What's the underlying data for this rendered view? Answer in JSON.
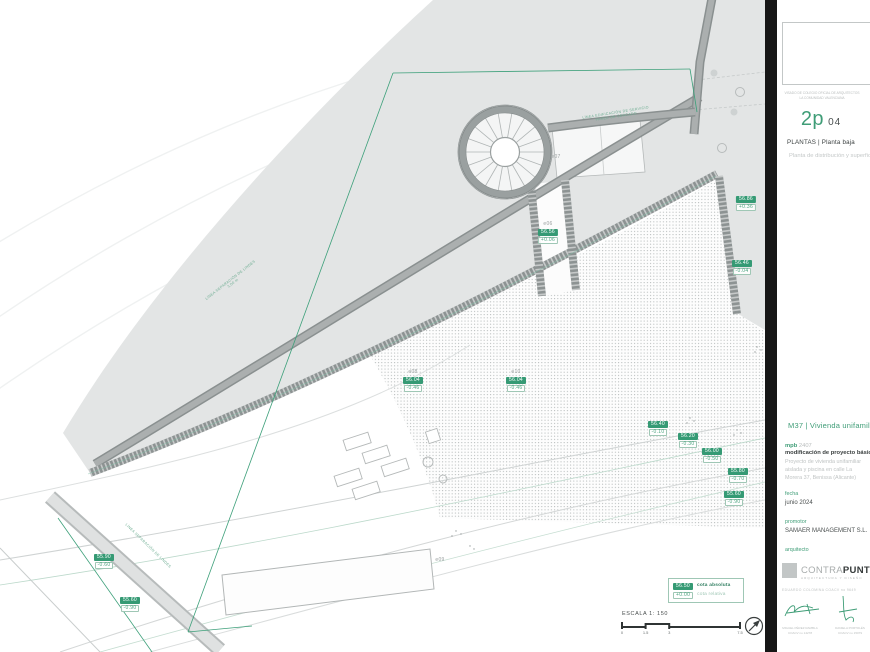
{
  "colors": {
    "accent": "#3f9d77",
    "chip_fill": "#359a74",
    "wall_gray": "#9aa0a0",
    "terrain_fill": "#e3e5e5"
  },
  "panel": {
    "visado_line1": "VISADO DE COLEGIO OFICIAL DE ARQUITECTOS",
    "visado_line2": "LA COMUNIDAD VALENCIANA",
    "sheet_code": "2p",
    "sheet_number": "04",
    "series_title": "PLANTAS | Planta baja",
    "sheet_subtitle": "Planta de distribución y superficies",
    "project_title": "M37 | Vivienda unifamiliar",
    "ref_label": "mpb",
    "ref_number": "2407",
    "mod_title": "modificación de proyecto básico",
    "desc_line1": "Proyecto de vivienda unifamiliar",
    "desc_line2": "aislada y piscina en calle La",
    "desc_line3": "Morera 37, Benissa (Alicante)",
    "fecha_label": "fecha",
    "fecha_value": "junio 2024",
    "promotor_label": "promotor",
    "promotor_value": "SAMAER MANAGEMENT S.L.",
    "arquitecto_label": "arquitecto",
    "logo_light": "CONTRA",
    "logo_bold": "PUNTO",
    "logo_sub": "ARQUITECTURA Y DISEÑO",
    "logo_line": "EDUARDO COLOMINA COACV no 9649",
    "sig1_name": "MIGUEL PÉREZ RAMBLA",
    "sig1_num": "COACV no 14278",
    "sig2_name": "DANIELA PORTOLÉS",
    "sig2_num": "COACV no 15079"
  },
  "legend": {
    "abs_chip": "56.50",
    "abs_label": "cota absoluta",
    "rel_chip": "+0.00",
    "rel_label": "cota relativa"
  },
  "scale": {
    "label": "ESCALA 1: 150",
    "ticks": [
      "0",
      "1.5",
      "3",
      "7.5"
    ],
    "tick_values": [
      0,
      1.5,
      3,
      7.5
    ],
    "max": 7.5
  },
  "plan": {
    "levels": [
      {
        "code": "e06",
        "abs": "56.56",
        "rel": "+0.06",
        "x": 548,
        "y": 222
      },
      {
        "code": "e08",
        "abs": "56.04",
        "rel": "-0.46",
        "x": 413,
        "y": 370
      },
      {
        "code": "e10",
        "abs": "56.04",
        "rel": "-0.46",
        "x": 516,
        "y": 370
      },
      {
        "abs": "56.86",
        "rel": "+0.36",
        "x": 746,
        "y": 196
      },
      {
        "abs": "56.46",
        "rel": "-0.04",
        "x": 742,
        "y": 260
      },
      {
        "abs": "56.40",
        "rel": "-0.10",
        "x": 658,
        "y": 421
      },
      {
        "abs": "56.20",
        "rel": "-0.30",
        "x": 688,
        "y": 433
      },
      {
        "abs": "56.00",
        "rel": "-0.50",
        "x": 712,
        "y": 448
      },
      {
        "abs": "55.80",
        "rel": "-0.70",
        "x": 738,
        "y": 468
      },
      {
        "abs": "55.60",
        "rel": "-0.90",
        "x": 734,
        "y": 491
      },
      {
        "abs": "55.90",
        "rel": "-0.60",
        "x": 104,
        "y": 554
      },
      {
        "abs": "55.60",
        "rel": "-0.90",
        "x": 130,
        "y": 597
      },
      {
        "code": "e07",
        "x": 556,
        "y": 155
      },
      {
        "code": "e09",
        "x": 440,
        "y": 558
      }
    ],
    "annotations": [
      {
        "line1": "LÍNEA EDIFICACIÓN DE SERVICIO",
        "line2": "PARED DE CERCADO",
        "x": 616,
        "y": 115,
        "rot": -9
      },
      {
        "line1": "LÍNEA SEPARACIÓN DE LINDES",
        "line2": "3,00 m",
        "x": 232,
        "y": 282,
        "rot": -38
      },
      {
        "line1": "LÍNEA SEPARACIÓN DE LINDES",
        "line2": "",
        "x": 148,
        "y": 546,
        "rot": 44
      }
    ]
  }
}
